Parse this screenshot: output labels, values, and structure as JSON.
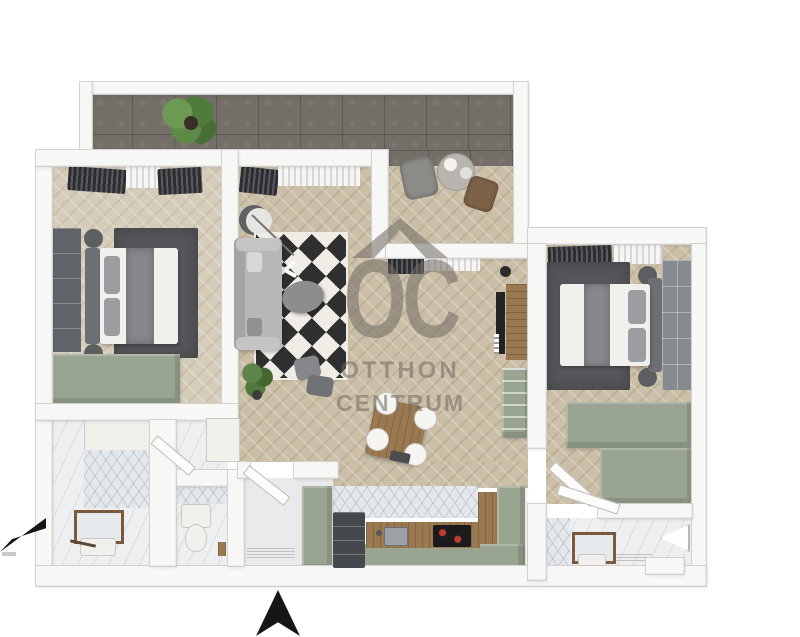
{
  "watermark": {
    "logo": "OC",
    "line1": "OTTHON",
    "line2": "CENTRUM"
  },
  "icons": {
    "watermark_roof": "house-roof",
    "entrance_arrow": "arrow-up",
    "compass_arrow": "arrow-lower-left"
  },
  "colors": {
    "sage": "#99a591",
    "terrace": "#736e67",
    "parquet": "#cbbfa8",
    "parquet-light": "#d6ccba",
    "rug": "#54565a",
    "wood": "#9a7950",
    "marble": "#edeff1",
    "wall": "#f7f7f5",
    "wall-edge": "#d2d1ce",
    "wm": "#6f6a62",
    "dark-furn": "#5b5e61",
    "ink": "#161616",
    "plant": "#55803f"
  }
}
